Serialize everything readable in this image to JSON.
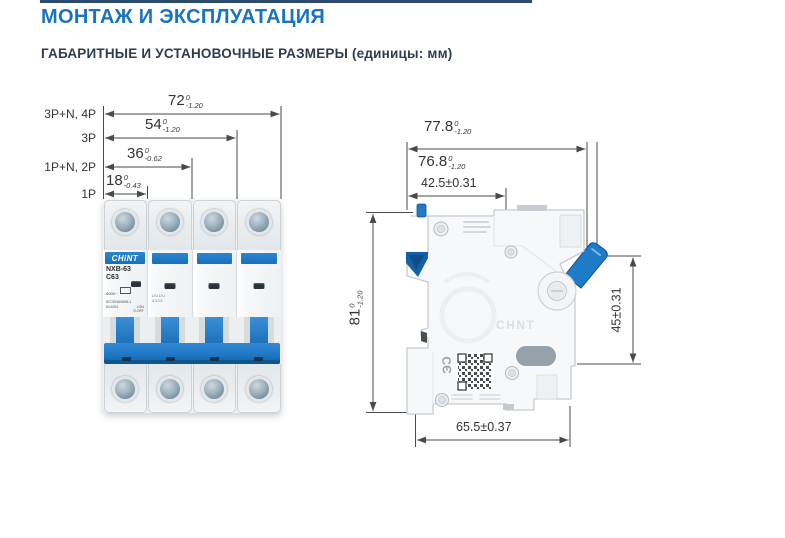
{
  "page": {
    "title": "МОНТАЖ И ЭКСПЛУАТАЦИЯ",
    "subtitle": "ГАБАРИТНЫЕ И УСТАНОВОЧНЫЕ РАЗМЕРЫ (единицы: мм)"
  },
  "colors": {
    "accent_blue": "#1a73c2",
    "navy": "#2c4a6e",
    "breaker_blue": "#1e7bc8",
    "drawing_line": "#4a4a4a"
  },
  "front_view": {
    "dimensions": [
      {
        "label": "3P+N, 4P",
        "value": "72",
        "sup": "0",
        "sub": "-1.20"
      },
      {
        "label": "3P",
        "value": "54",
        "sup": "0",
        "sub": "-1.20"
      },
      {
        "label": "1P+N, 2P",
        "value": "36",
        "sup": "0",
        "sub": "-0.62"
      },
      {
        "label": "1P",
        "value": "18",
        "sup": "0",
        "sub": "-0.43"
      }
    ],
    "breaker": {
      "brand": "CHiNT",
      "model": "NXB-63",
      "rating": "C63",
      "voltage": "400V~",
      "standard": "IEC/EN60898-1",
      "code": "814254",
      "on_off": "I-ON\nO-OFF",
      "pole2_marks_1": "UUUU",
      "pole2_marks_2": "3333"
    }
  },
  "side_view": {
    "width_outer": {
      "value": "77.8",
      "sup": "0",
      "sub": "-1.20"
    },
    "width_inner": {
      "value": "76.8",
      "sup": "0",
      "sub": "-1.20"
    },
    "mount_top": "42.5±0.31",
    "height": {
      "value": "81",
      "sup": "0",
      "sub": "-1.20"
    },
    "height_right": "45±0.31",
    "bottom": "65.5±0.37",
    "ce": "CЄ",
    "watermark": "CHNT"
  }
}
